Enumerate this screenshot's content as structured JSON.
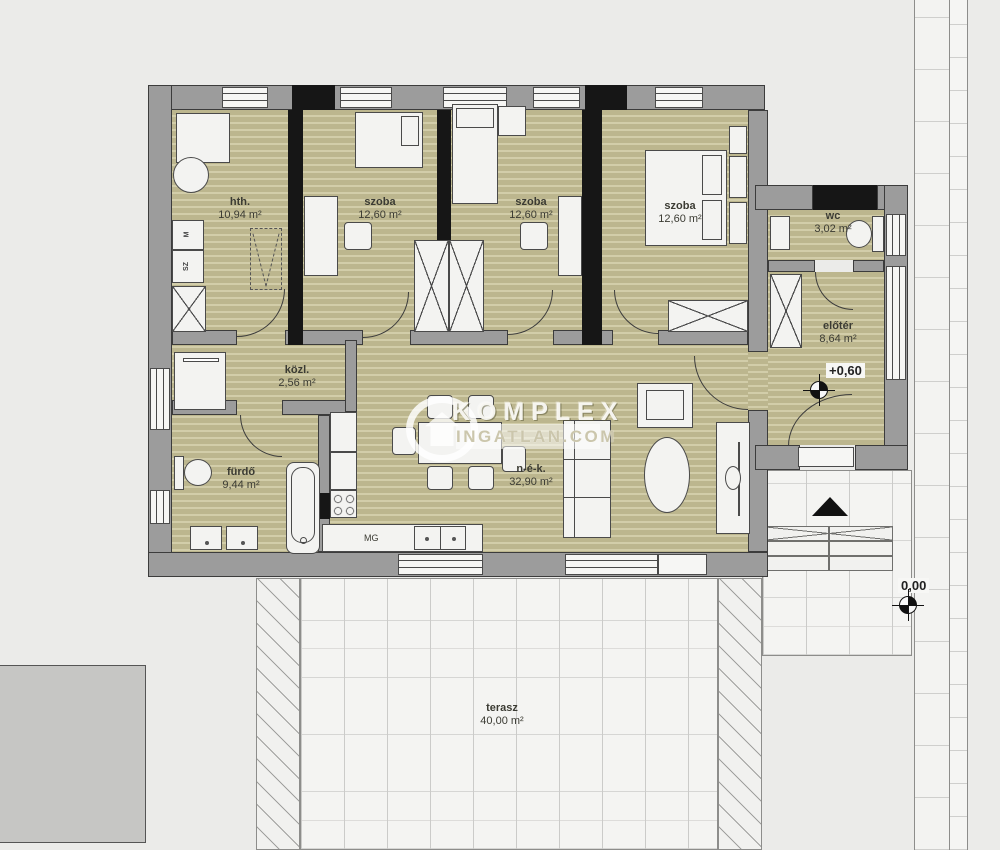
{
  "watermark": {
    "title": "KOMPLEX",
    "subtitle": "INGATLAN.COM"
  },
  "rooms": {
    "hth": {
      "name": "hth.",
      "area": "10,94 m²"
    },
    "szoba_a": {
      "name": "szoba",
      "area": "12,60 m²"
    },
    "szoba_b": {
      "name": "szoba",
      "area": "12,60 m²"
    },
    "szoba_c": {
      "name": "szoba",
      "area": "12,60 m²"
    },
    "wc": {
      "name": "wc",
      "area": "3,02 m²"
    },
    "eloter": {
      "name": "előtér",
      "area": "8,64 m²"
    },
    "kozl": {
      "name": "közl.",
      "area": "2,56 m²"
    },
    "furdo": {
      "name": "fürdő",
      "area": "9,44 m²"
    },
    "nek": {
      "name": "n-é-k.",
      "area": "32,90 m²"
    },
    "terasz": {
      "name": "terasz",
      "area": "40,00 m²"
    }
  },
  "markers": {
    "entry_level": "+0,60",
    "ground_level": "0,00"
  },
  "cabinet_labels": {
    "m": "M",
    "sz": "SZ",
    "mg": "MG"
  },
  "colors": {
    "background": "#ebebe9",
    "floor_base": "#bcb68e",
    "floor_stripe": "#d2cda9",
    "wall_gray": "#9c9c9c",
    "wall_outline": "#3c3c3c",
    "wall_black": "#161616",
    "paving": "#f4f4f2",
    "furniture": "#f3f3f1",
    "outbuilding_gray": "#c6c6c4"
  }
}
